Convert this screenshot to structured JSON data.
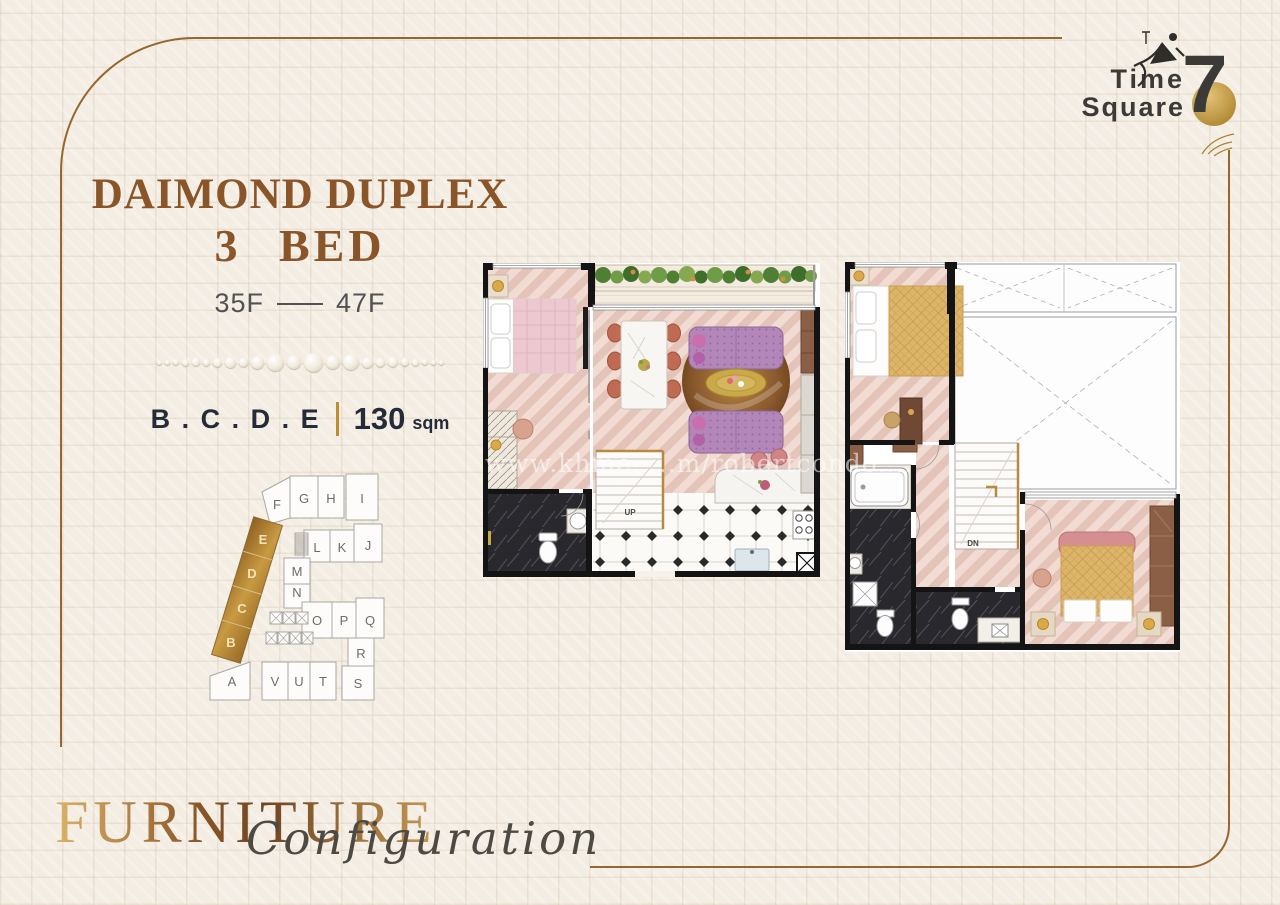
{
  "page": {
    "background_color": "#f3ede3",
    "frame_color": "#96662f"
  },
  "logo": {
    "word1": "Time",
    "word2": "Square",
    "number": "7",
    "accent_color": "#b68f3a"
  },
  "header": {
    "title": "DAIMOND DUPLEX",
    "subtitle": "3 BED",
    "floor_from": "35F",
    "floor_to": "47F",
    "unit_letters": "B . C . D . E",
    "area_value": "130",
    "area_unit": "sqm"
  },
  "keyplan": {
    "highlighted": [
      "E",
      "D",
      "C",
      "B"
    ],
    "row_top": [
      "F",
      "G",
      "H",
      "I"
    ],
    "row_second": [
      "L",
      "K",
      "J"
    ],
    "row_mid": [
      "M",
      "N"
    ],
    "row_third": [
      "O",
      "P",
      "Q"
    ],
    "row_fourth": [
      "R"
    ],
    "row_bottom": [
      "A",
      "V",
      "U",
      "T",
      "S"
    ],
    "highlight_color": "#b08030"
  },
  "floorplans": {
    "lower": {
      "stair_label": "UP"
    },
    "upper": {
      "stair_label": "DN"
    }
  },
  "watermark": "www.khme.....m/robertcondo....",
  "footer": {
    "title": "FURNITURE",
    "script": "Configuration"
  }
}
